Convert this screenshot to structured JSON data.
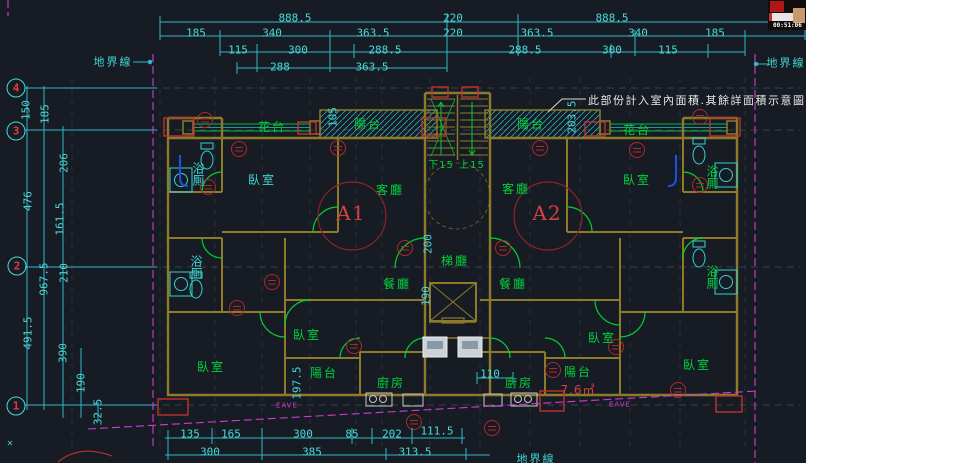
{
  "colors": {
    "background": "#171c24",
    "dimension_cyan": "#49d8d8",
    "room_green": "#00d23c",
    "tag_red": "#d84040",
    "wall_olive": "#8d7b2a",
    "property_magenta": "#d23ad2",
    "note_white": "#e8e8e8",
    "hatch_cyan": "#2aa8b8"
  },
  "video_overlay": {
    "timestamp": "00:51:06"
  },
  "note": "此部份計入室內面積.其餘詳面積示意圖",
  "boundary_labels": {
    "top_left": "地界線",
    "top_right": "地界線",
    "bottom": "地界線"
  },
  "grid_bubbles": [
    "4",
    "3",
    "2",
    "1"
  ],
  "dims": {
    "top_row1": [
      "888.5",
      "220",
      "888.5"
    ],
    "top_row2": [
      "185",
      "340",
      "363.5",
      "220",
      "363.5",
      "340",
      "185"
    ],
    "top_row3": [
      "115",
      "300",
      "288.5",
      "288.5",
      "300",
      "115"
    ],
    "top_row4": [
      "288",
      "363.5"
    ],
    "left_col": [
      "185",
      "150",
      "206",
      "476",
      "161.5",
      "967.5",
      "210",
      "491.5",
      "390",
      "190",
      "32.5"
    ],
    "bottom_row1": [
      "135",
      "165",
      "300",
      "85",
      "202",
      "111.5"
    ],
    "bottom_row2": [
      "300",
      "385",
      "313.5"
    ],
    "inner": [
      "105",
      "203.5",
      "200",
      "190",
      "197.5",
      "110"
    ]
  },
  "labels": {
    "planters": [
      "花台",
      "花台"
    ],
    "balconies_top": [
      "陽台",
      "陽台"
    ],
    "living": [
      "客廳",
      "客廳"
    ],
    "bedrooms": [
      "臥室",
      "臥室",
      "臥室",
      "臥室",
      "臥室",
      "臥室"
    ],
    "baths": [
      "浴厠",
      "浴厠",
      "浴厠",
      "浴厠"
    ],
    "stair_hall": "梯廳",
    "dining": [
      "餐廳",
      "餐廳"
    ],
    "kitchens": [
      "廚房",
      "廚房"
    ],
    "balconies_bottom": [
      "陽台",
      "陽台"
    ],
    "balcony_area": "7.6㎡",
    "units": [
      "A1",
      "A2"
    ],
    "stair_down": "下15",
    "stair_up": "上15",
    "eave": [
      "EAVE",
      "EAVE"
    ]
  },
  "misc": {
    "ucs_marker": "✕"
  }
}
